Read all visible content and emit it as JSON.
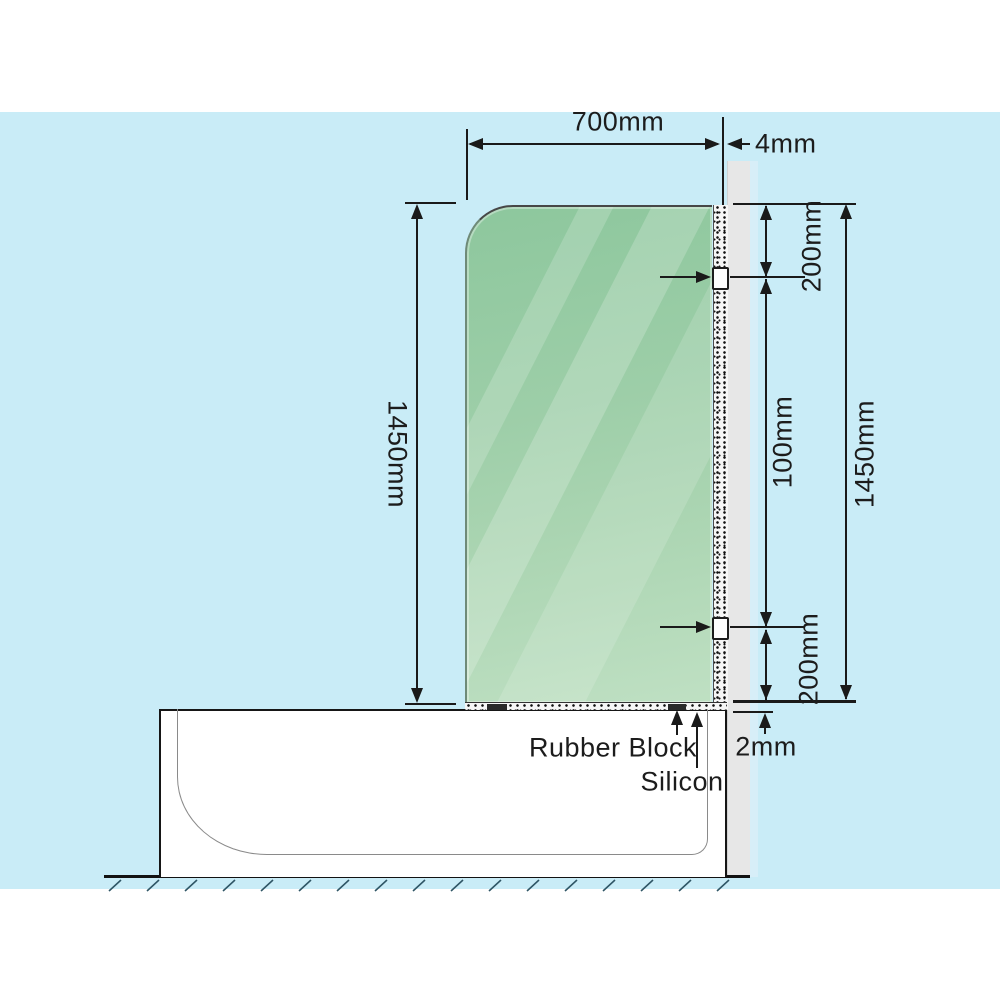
{
  "diagram": {
    "dimensions": {
      "glass_width": "700mm",
      "glass_thickness": "4mm",
      "glass_height_left": "1450mm",
      "wall_height_right": "1450mm",
      "top_bracket_offset": "200mm",
      "bracket_spacing": "100mm",
      "bottom_bracket_offset": "200mm",
      "bottom_gap": "2mm"
    },
    "callouts": {
      "rubber_block": "Rubber Block",
      "silicon": "Silicon"
    },
    "colors": {
      "background": "#c9ecf7",
      "glass_green_dark": "#8dc79d",
      "glass_green_light": "#bfe0c3",
      "wall_gray": "#e7e7e7",
      "line": "#1a1a1a"
    }
  }
}
